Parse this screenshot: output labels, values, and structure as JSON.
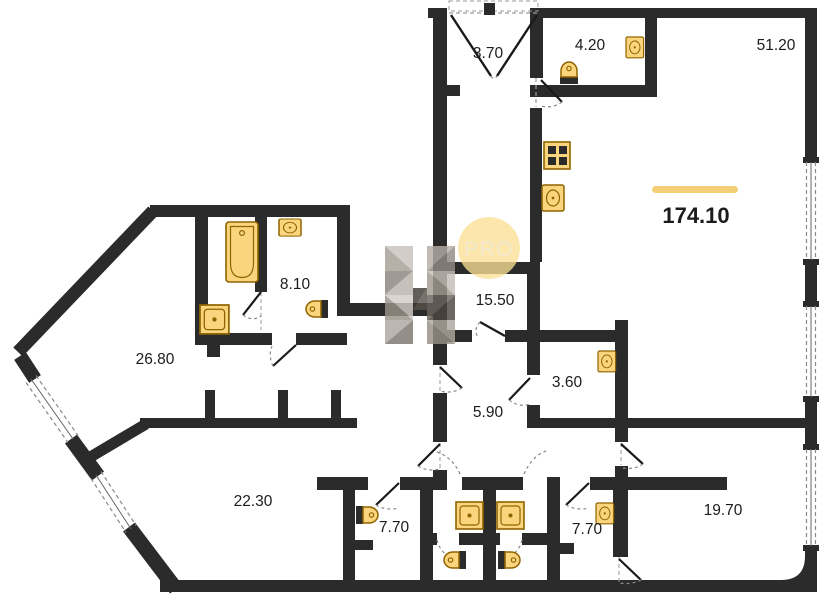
{
  "plan": {
    "total": {
      "area": "174.10"
    },
    "watermark": {
      "label": "PRO"
    },
    "rooms": {
      "hallway": {
        "area": "3.70"
      },
      "wc_hall": {
        "area": "4.20"
      },
      "living": {
        "area": "51.20"
      },
      "bath": {
        "area": "8.10"
      },
      "inner_hall": {
        "area": "15.50"
      },
      "corridor": {
        "area": "26.80"
      },
      "pantry": {
        "area": "3.60"
      },
      "passage": {
        "area": "5.90"
      },
      "room_left": {
        "area": "22.30"
      },
      "bath_left": {
        "area": "7.70"
      },
      "bath_right": {
        "area": "7.70"
      },
      "room_right": {
        "area": "19.70"
      }
    },
    "colors": {
      "wall": "#2b2b2b",
      "fixture_fill": "#fbd57d",
      "fixture_stroke": "#8f6400",
      "accent_bar": "#f3cf77",
      "watermark_circle": "#fbdf93",
      "watermark_text": "#efe5c6"
    },
    "fixture_icons": [
      "bathtub-icon",
      "shower-icon",
      "toilet-icon",
      "sink-icon",
      "stove-icon"
    ]
  }
}
